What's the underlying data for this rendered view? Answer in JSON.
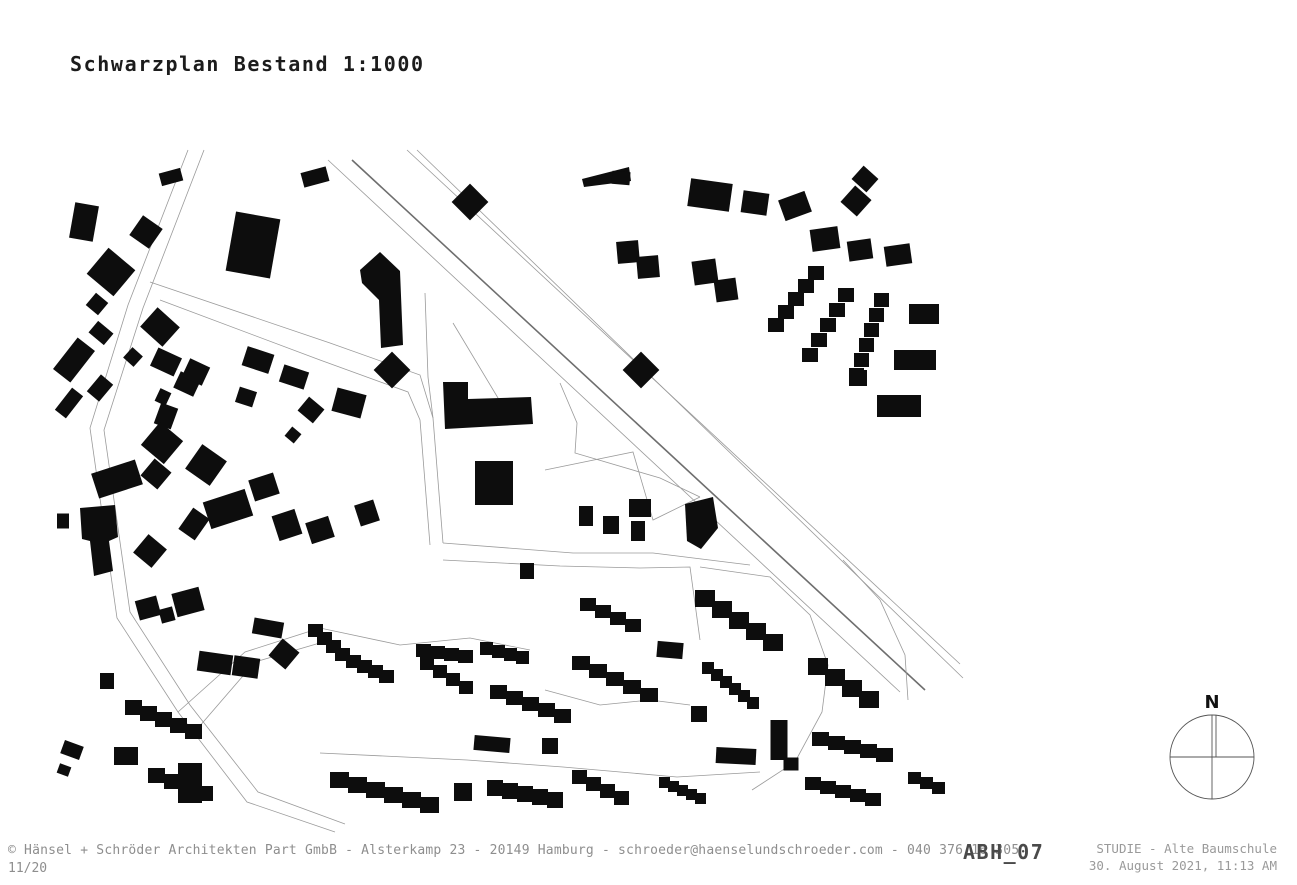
{
  "title": {
    "text": "Schwarzplan Bestand 1:1000"
  },
  "footer": {
    "copyright": "© Hänsel + Schröder Architekten Part GmbB - Alsterkamp 23 - 20149 Hamburg - schroeder@haenselundschroeder.com - 040 376 16 305",
    "page": "11/20",
    "sheet_code": "ABH_07",
    "project": "STUDIE - Alte Baumschule",
    "datetime": "30. August 2021, 11:13 AM"
  },
  "compass": {
    "label": "N"
  },
  "colors": {
    "building": "#0d0d0d",
    "road_thin": "#9a9a9a",
    "road_dark": "#6e6e6e",
    "compass_stroke": "#555555",
    "text_dark": "#1c1c1c",
    "text_gray": "#8e8e8e"
  },
  "map": {
    "roads": [
      {
        "k": "thin",
        "pts": [
          [
            328,
            160
          ],
          [
            900,
            692
          ]
        ]
      },
      {
        "k": "dark",
        "pts": [
          [
            352,
            160
          ],
          [
            925,
            690
          ]
        ]
      },
      {
        "k": "thin",
        "pts": [
          [
            407,
            150
          ],
          [
            960,
            664
          ]
        ]
      },
      {
        "k": "thin",
        "pts": [
          [
            417,
            150
          ],
          [
            963,
            678
          ]
        ]
      },
      {
        "k": "thin",
        "pts": [
          [
            188,
            150
          ],
          [
            128,
            305
          ],
          [
            90,
            428
          ],
          [
            117,
            618
          ],
          [
            178,
            712
          ],
          [
            247,
            802
          ],
          [
            335,
            832
          ]
        ]
      },
      {
        "k": "thin",
        "pts": [
          [
            204,
            150
          ],
          [
            143,
            308
          ],
          [
            104,
            430
          ],
          [
            130,
            612
          ],
          [
            190,
            705
          ],
          [
            258,
            792
          ],
          [
            345,
            824
          ]
        ]
      },
      {
        "k": "thin",
        "pts": [
          [
            150,
            282
          ],
          [
            330,
            343
          ],
          [
            420,
            375
          ],
          [
            433,
            418
          ],
          [
            443,
            543
          ]
        ]
      },
      {
        "k": "thin",
        "pts": [
          [
            160,
            300
          ],
          [
            320,
            360
          ],
          [
            408,
            392
          ],
          [
            420,
            420
          ],
          [
            430,
            545
          ]
        ]
      },
      {
        "k": "thin",
        "pts": [
          [
            560,
            383
          ],
          [
            577,
            423
          ],
          [
            575,
            453
          ],
          [
            660,
            478
          ],
          [
            700,
            497
          ]
        ]
      },
      {
        "k": "thin",
        "pts": [
          [
            443,
            543
          ],
          [
            573,
            553
          ],
          [
            653,
            553
          ],
          [
            750,
            565
          ]
        ]
      },
      {
        "k": "thin",
        "pts": [
          [
            443,
            560
          ],
          [
            560,
            566
          ],
          [
            640,
            568
          ],
          [
            690,
            567
          ],
          [
            700,
            640
          ]
        ]
      },
      {
        "k": "thin",
        "pts": [
          [
            545,
            470
          ],
          [
            633,
            452
          ],
          [
            653,
            520
          ],
          [
            700,
            497
          ]
        ]
      },
      {
        "k": "thin",
        "pts": [
          [
            178,
            712
          ],
          [
            245,
            652
          ],
          [
            320,
            628
          ],
          [
            400,
            645
          ],
          [
            470,
            638
          ],
          [
            530,
            650
          ]
        ]
      },
      {
        "k": "thin",
        "pts": [
          [
            192,
            735
          ],
          [
            255,
            662
          ],
          [
            330,
            640
          ]
        ]
      },
      {
        "k": "thin",
        "pts": [
          [
            320,
            753
          ],
          [
            467,
            760
          ],
          [
            563,
            767
          ],
          [
            677,
            777
          ],
          [
            760,
            772
          ]
        ]
      },
      {
        "k": "thin",
        "pts": [
          [
            545,
            690
          ],
          [
            600,
            705
          ],
          [
            650,
            700
          ],
          [
            690,
            705
          ]
        ]
      },
      {
        "k": "thin",
        "pts": [
          [
            700,
            567
          ],
          [
            770,
            577
          ],
          [
            810,
            615
          ],
          [
            828,
            665
          ],
          [
            822,
            712
          ],
          [
            795,
            762
          ],
          [
            752,
            790
          ]
        ]
      },
      {
        "k": "thin",
        "pts": [
          [
            843,
            560
          ],
          [
            880,
            600
          ],
          [
            905,
            655
          ],
          [
            908,
            700
          ]
        ]
      },
      {
        "k": "thin",
        "pts": [
          [
            425,
            293
          ],
          [
            428,
            377
          ],
          [
            433,
            418
          ]
        ]
      },
      {
        "k": "thin",
        "pts": [
          [
            453,
            323
          ],
          [
            510,
            418
          ]
        ]
      }
    ],
    "buildings": [
      [
        "r",
        84,
        222,
        24,
        36,
        10
      ],
      [
        "r",
        146,
        232,
        24,
        24,
        35
      ],
      [
        "r",
        171,
        177,
        22,
        13,
        -15
      ],
      [
        "r",
        315,
        177,
        26,
        15,
        -15
      ],
      [
        "r",
        111,
        272,
        35,
        34,
        40
      ],
      [
        "r",
        97,
        304,
        16,
        16,
        40
      ],
      [
        "r",
        101,
        333,
        20,
        15,
        40
      ],
      [
        "r",
        74,
        360,
        22,
        40,
        38
      ],
      [
        "r",
        69,
        403,
        14,
        28,
        38
      ],
      [
        "r",
        160,
        327,
        30,
        26,
        42
      ],
      [
        "r",
        133,
        357,
        14,
        14,
        42
      ],
      [
        "r",
        100,
        388,
        16,
        22,
        40
      ],
      [
        "r",
        166,
        362,
        26,
        20,
        25
      ],
      [
        "r",
        187,
        384,
        22,
        18,
        25
      ],
      [
        "r",
        163,
        397,
        12,
        14,
        25
      ],
      [
        "r",
        166,
        416,
        18,
        22,
        20
      ],
      [
        "r",
        196,
        372,
        22,
        20,
        25
      ],
      [
        "r",
        253,
        245,
        45,
        60,
        10
      ],
      [
        "r",
        258,
        360,
        28,
        20,
        18
      ],
      [
        "r",
        294,
        377,
        26,
        18,
        18
      ],
      [
        "r",
        246,
        397,
        18,
        16,
        18
      ],
      [
        "r",
        349,
        403,
        30,
        24,
        15
      ],
      [
        "r",
        311,
        410,
        20,
        18,
        40
      ],
      [
        "r",
        293,
        435,
        12,
        12,
        40
      ],
      [
        "p",
        [
          [
            360,
            270
          ],
          [
            380,
            252
          ],
          [
            400,
            271
          ],
          [
            403,
            345
          ],
          [
            381,
            348
          ],
          [
            379,
            300
          ],
          [
            362,
            283
          ]
        ]
      ],
      [
        "r",
        392,
        370,
        26,
        26,
        45
      ],
      [
        "r",
        641,
        370,
        26,
        26,
        45
      ],
      [
        "r",
        470,
        202,
        26,
        26,
        45
      ],
      [
        "p",
        [
          [
            582,
            179
          ],
          [
            629,
            167
          ],
          [
            631,
            181
          ],
          [
            584,
            187
          ]
        ]
      ],
      [
        "r",
        621,
        178,
        18,
        13,
        5
      ],
      [
        "r",
        117,
        479,
        46,
        26,
        -18
      ],
      [
        "r",
        162,
        443,
        30,
        30,
        40
      ],
      [
        "r",
        156,
        474,
        22,
        22,
        40
      ],
      [
        "r",
        206,
        465,
        30,
        30,
        35
      ],
      [
        "p",
        [
          [
            80,
            508
          ],
          [
            115,
            505
          ],
          [
            118,
            537
          ],
          [
            109,
            541
          ],
          [
            113,
            571
          ],
          [
            94,
            576
          ],
          [
            90,
            541
          ],
          [
            82,
            539
          ]
        ]
      ],
      [
        "r",
        63,
        521,
        12,
        15,
        0
      ],
      [
        "r",
        150,
        551,
        24,
        24,
        40
      ],
      [
        "r",
        194,
        524,
        20,
        26,
        35
      ],
      [
        "r",
        228,
        509,
        44,
        28,
        -18
      ],
      [
        "r",
        264,
        487,
        26,
        22,
        -18
      ],
      [
        "r",
        287,
        525,
        24,
        26,
        -18
      ],
      [
        "r",
        320,
        530,
        24,
        22,
        -18
      ],
      [
        "r",
        367,
        513,
        20,
        22,
        -18
      ],
      [
        "r",
        148,
        608,
        22,
        20,
        -15
      ],
      [
        "r",
        167,
        615,
        14,
        14,
        -15
      ],
      [
        "r",
        188,
        602,
        28,
        24,
        -15
      ],
      [
        "p",
        [
          [
            443,
            382
          ],
          [
            468,
            382
          ],
          [
            468,
            399
          ],
          [
            531,
            397
          ],
          [
            533,
            424
          ],
          [
            445,
            429
          ]
        ]
      ],
      [
        "r",
        494,
        483,
        38,
        44,
        0
      ],
      [
        "r",
        586,
        516,
        14,
        20,
        0
      ],
      [
        "r",
        611,
        525,
        16,
        18,
        0
      ],
      [
        "r",
        640,
        508,
        22,
        18,
        0
      ],
      [
        "r",
        638,
        531,
        14,
        20,
        0
      ],
      [
        "p",
        [
          [
            685,
            504
          ],
          [
            713,
            497
          ],
          [
            718,
            528
          ],
          [
            701,
            549
          ],
          [
            687,
            541
          ]
        ]
      ],
      [
        "r",
        527,
        571,
        14,
        16,
        0
      ],
      [
        "r",
        710,
        195,
        42,
        28,
        8
      ],
      [
        "r",
        755,
        203,
        26,
        22,
        8
      ],
      [
        "r",
        795,
        206,
        28,
        22,
        -20
      ],
      [
        "r",
        865,
        179,
        20,
        18,
        42
      ],
      [
        "r",
        856,
        201,
        22,
        22,
        42
      ],
      [
        "r",
        825,
        239,
        28,
        22,
        -8
      ],
      [
        "r",
        860,
        250,
        24,
        20,
        -8
      ],
      [
        "r",
        898,
        255,
        26,
        20,
        -8
      ],
      [
        "r",
        628,
        252,
        22,
        22,
        -5
      ],
      [
        "r",
        648,
        267,
        22,
        22,
        -5
      ],
      [
        "r",
        705,
        272,
        24,
        24,
        -8
      ],
      [
        "r",
        726,
        290,
        22,
        22,
        -8
      ],
      [
        "s",
        808,
        266,
        5,
        -10,
        13,
        16,
        14
      ],
      [
        "s",
        838,
        288,
        5,
        -9,
        15,
        16,
        14
      ],
      [
        "s",
        874,
        293,
        6,
        -5,
        15,
        15,
        14
      ],
      [
        "r",
        924,
        314,
        30,
        20,
        0
      ],
      [
        "r",
        915,
        360,
        42,
        20,
        0
      ],
      [
        "r",
        858,
        378,
        18,
        16,
        0
      ],
      [
        "r",
        899,
        406,
        44,
        22,
        0
      ],
      [
        "r",
        107,
        681,
        14,
        16,
        0
      ],
      [
        "r",
        126,
        756,
        24,
        18,
        0
      ],
      [
        "r",
        190,
        783,
        24,
        40,
        0
      ],
      [
        "r",
        72,
        750,
        20,
        14,
        20
      ],
      [
        "r",
        64,
        770,
        12,
        10,
        20
      ],
      [
        "r",
        215,
        663,
        34,
        20,
        8
      ],
      [
        "r",
        246,
        667,
        26,
        20,
        8
      ],
      [
        "r",
        284,
        654,
        22,
        22,
        40
      ],
      [
        "r",
        268,
        628,
        30,
        16,
        10
      ],
      [
        "s",
        308,
        624,
        4,
        9,
        8,
        15,
        13
      ],
      [
        "s",
        346,
        655,
        4,
        11,
        5,
        15,
        13
      ],
      [
        "s",
        125,
        700,
        5,
        15,
        6,
        17,
        15
      ],
      [
        "s",
        148,
        768,
        4,
        16,
        6,
        17,
        15
      ],
      [
        "s",
        330,
        772,
        6,
        18,
        5,
        19,
        16
      ],
      [
        "r",
        463,
        792,
        18,
        18,
        0
      ],
      [
        "s",
        487,
        780,
        5,
        15,
        3,
        16,
        16
      ],
      [
        "s",
        572,
        770,
        4,
        14,
        7,
        15,
        14
      ],
      [
        "s",
        416,
        644,
        4,
        14,
        2,
        15,
        13
      ],
      [
        "s",
        420,
        657,
        4,
        13,
        8,
        14,
        13
      ],
      [
        "s",
        480,
        642,
        4,
        12,
        3,
        13,
        13
      ],
      [
        "s",
        490,
        685,
        5,
        16,
        6,
        17,
        14
      ],
      [
        "s",
        572,
        656,
        5,
        17,
        8,
        18,
        14
      ],
      [
        "r",
        492,
        744,
        36,
        15,
        5
      ],
      [
        "r",
        550,
        746,
        16,
        16,
        0
      ],
      [
        "s",
        580,
        598,
        4,
        15,
        7,
        16,
        13
      ],
      [
        "r",
        670,
        650,
        26,
        16,
        5
      ],
      [
        "s",
        695,
        590,
        5,
        17,
        11,
        20,
        17
      ],
      [
        "s",
        702,
        662,
        6,
        9,
        7,
        12,
        12
      ],
      [
        "r",
        699,
        714,
        16,
        16,
        0
      ],
      [
        "r",
        779,
        740,
        17,
        40,
        0
      ],
      [
        "r",
        791,
        764,
        15,
        13,
        0
      ],
      [
        "r",
        736,
        756,
        40,
        16,
        3
      ],
      [
        "s",
        808,
        658,
        4,
        17,
        11,
        20,
        17
      ],
      [
        "s",
        812,
        732,
        5,
        16,
        4,
        17,
        14
      ],
      [
        "s",
        805,
        777,
        5,
        15,
        4,
        16,
        13
      ],
      [
        "s",
        659,
        777,
        5,
        9,
        4,
        11,
        11
      ],
      [
        "s",
        908,
        772,
        3,
        12,
        5,
        13,
        12
      ]
    ]
  }
}
